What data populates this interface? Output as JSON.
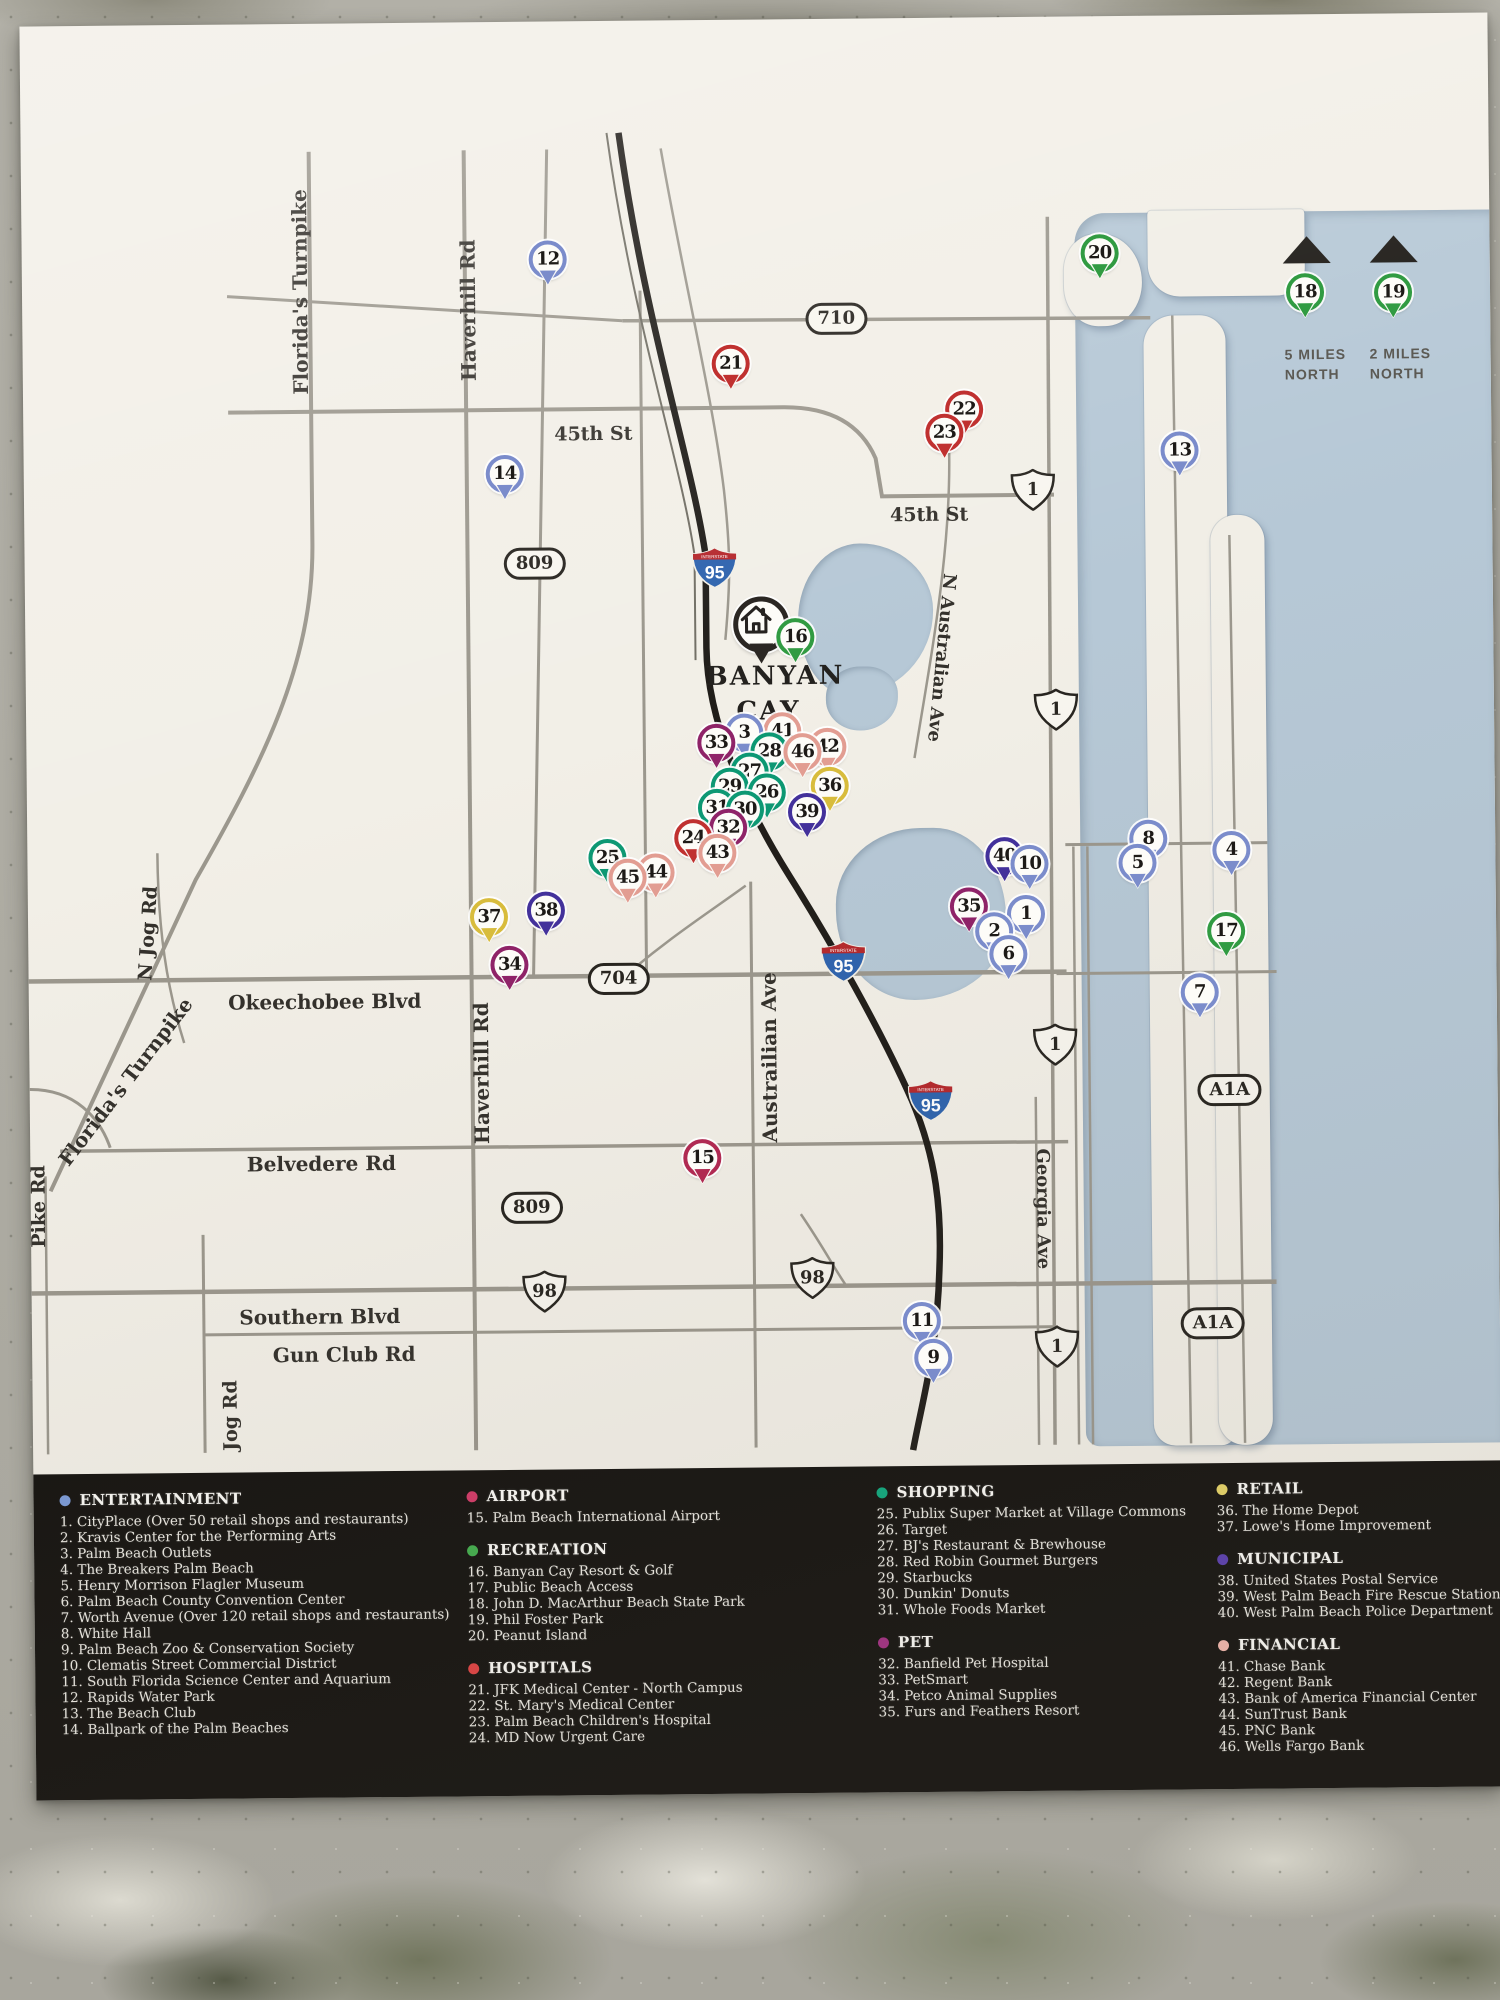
{
  "map": {
    "colors": {
      "land": "#f2efe7",
      "water": "#b6c8d6",
      "interstate_blue": "#2e63ae",
      "interstate_red": "#b5282c"
    },
    "home": {
      "label": "BANYAN CAY",
      "icon": "home-icon",
      "x": 736,
      "y": 605
    },
    "compass": [
      {
        "pin": 18,
        "lines": "5 MILES NORTH",
        "x": 1262,
        "tri_x": 1285
      },
      {
        "pin": 19,
        "lines": "2 MILES NORTH",
        "x": 1347,
        "tri_x": 1372
      }
    ],
    "categories": {
      "entertainment": {
        "label": "ENTERTAINMENT",
        "dot": "#7b9bd8",
        "pin": "#7b8ccb"
      },
      "airport": {
        "label": "AIRPORT",
        "dot": "#d23a68",
        "pin": "#b02a52"
      },
      "recreation": {
        "label": "RECREATION",
        "dot": "#43ae4e",
        "pin": "#319b42"
      },
      "hospitals": {
        "label": "HOSPITALS",
        "dot": "#e04343",
        "pin": "#c03130"
      },
      "shopping": {
        "label": "SHOPPING",
        "dot": "#10a87e",
        "pin": "#0d9873"
      },
      "pet": {
        "label": "PET",
        "dot": "#a23083",
        "pin": "#8f2368"
      },
      "retail": {
        "label": "RETAIL",
        "dot": "#e6d468",
        "pin": "#d8bc3c"
      },
      "municipal": {
        "label": "MUNICIPAL",
        "dot": "#5a3fb0",
        "pin": "#43319b"
      },
      "financial": {
        "label": "FINANCIAL",
        "dot": "#f2b7ad",
        "pin": "#e29d92"
      }
    },
    "pins": [
      {
        "n": 1,
        "cat": "entertainment",
        "x": 998,
        "y": 897
      },
      {
        "n": 2,
        "cat": "entertainment",
        "x": 966,
        "y": 914
      },
      {
        "n": 3,
        "cat": "entertainment",
        "x": 718,
        "y": 713
      },
      {
        "n": 4,
        "cat": "entertainment",
        "x": 1204,
        "y": 835
      },
      {
        "n": 5,
        "cat": "entertainment",
        "x": 1110,
        "y": 847
      },
      {
        "n": 6,
        "cat": "entertainment",
        "x": 980,
        "y": 937
      },
      {
        "n": 7,
        "cat": "entertainment",
        "x": 1171,
        "y": 977
      },
      {
        "n": 8,
        "cat": "entertainment",
        "x": 1121,
        "y": 823
      },
      {
        "n": 9,
        "cat": "entertainment",
        "x": 901,
        "y": 1340
      },
      {
        "n": 10,
        "cat": "entertainment",
        "x": 1002,
        "y": 847
      },
      {
        "n": 11,
        "cat": "entertainment",
        "x": 890,
        "y": 1303
      },
      {
        "n": 12,
        "cat": "entertainment",
        "x": 526,
        "y": 238
      },
      {
        "n": 13,
        "cat": "entertainment",
        "x": 1156,
        "y": 435
      },
      {
        "n": 14,
        "cat": "entertainment",
        "x": 481,
        "y": 452
      },
      {
        "n": 15,
        "cat": "airport",
        "x": 672,
        "y": 1138
      },
      {
        "n": 16,
        "cat": "recreation",
        "x": 770,
        "y": 618
      },
      {
        "n": 17,
        "cat": "recreation",
        "x": 1198,
        "y": 916
      },
      {
        "n": 18,
        "cat": "recreation",
        "x": 1283,
        "y": 278
      },
      {
        "n": 19,
        "cat": "recreation",
        "x": 1371,
        "y": 279
      },
      {
        "n": 20,
        "cat": "recreation",
        "x": 1078,
        "y": 237
      },
      {
        "n": 21,
        "cat": "hospitals",
        "x": 708,
        "y": 344
      },
      {
        "n": 22,
        "cat": "hospitals",
        "x": 941,
        "y": 392
      },
      {
        "n": 23,
        "cat": "hospitals",
        "x": 921,
        "y": 415
      },
      {
        "n": 24,
        "cat": "hospitals",
        "x": 666,
        "y": 818
      },
      {
        "n": 25,
        "cat": "shopping",
        "x": 580,
        "y": 837
      },
      {
        "n": 26,
        "cat": "shopping",
        "x": 740,
        "y": 773
      },
      {
        "n": 27,
        "cat": "shopping",
        "x": 723,
        "y": 752
      },
      {
        "n": 28,
        "cat": "shopping",
        "x": 743,
        "y": 732
      },
      {
        "n": 29,
        "cat": "shopping",
        "x": 703,
        "y": 767
      },
      {
        "n": 30,
        "cat": "shopping",
        "x": 718,
        "y": 790
      },
      {
        "n": 31,
        "cat": "shopping",
        "x": 690,
        "y": 788
      },
      {
        "n": 32,
        "cat": "pet",
        "x": 701,
        "y": 808
      },
      {
        "n": 33,
        "cat": "pet",
        "x": 690,
        "y": 723
      },
      {
        "n": 34,
        "cat": "pet",
        "x": 481,
        "y": 943
      },
      {
        "n": 35,
        "cat": "pet",
        "x": 941,
        "y": 889
      },
      {
        "n": 36,
        "cat": "retail",
        "x": 803,
        "y": 767
      },
      {
        "n": 37,
        "cat": "retail",
        "x": 461,
        "y": 895
      },
      {
        "n": 38,
        "cat": "municipal",
        "x": 518,
        "y": 889
      },
      {
        "n": 39,
        "cat": "municipal",
        "x": 780,
        "y": 793
      },
      {
        "n": 40,
        "cat": "municipal",
        "x": 977,
        "y": 839
      },
      {
        "n": 41,
        "cat": "financial",
        "x": 756,
        "y": 712
      },
      {
        "n": 42,
        "cat": "financial",
        "x": 801,
        "y": 728
      },
      {
        "n": 43,
        "cat": "financial",
        "x": 690,
        "y": 833
      },
      {
        "n": 44,
        "cat": "financial",
        "x": 628,
        "y": 852
      },
      {
        "n": 45,
        "cat": "financial",
        "x": 600,
        "y": 857
      },
      {
        "n": 46,
        "cat": "financial",
        "x": 776,
        "y": 733
      }
    ],
    "shields": [
      {
        "type": "oval",
        "label": "710",
        "x": 814,
        "y": 300
      },
      {
        "type": "oval",
        "label": "809",
        "x": 510,
        "y": 542
      },
      {
        "type": "oval",
        "label": "809",
        "x": 501,
        "y": 1186
      },
      {
        "type": "oval",
        "label": "704",
        "x": 590,
        "y": 958
      },
      {
        "type": "oval",
        "label": "A1A",
        "x": 1200,
        "y": 1075
      },
      {
        "type": "oval",
        "label": "A1A",
        "x": 1181,
        "y": 1308
      },
      {
        "type": "us",
        "label": "1",
        "x": 1009,
        "y": 473
      },
      {
        "type": "us",
        "label": "1",
        "x": 1030,
        "y": 693
      },
      {
        "type": "us",
        "label": "1",
        "x": 1026,
        "y": 1028
      },
      {
        "type": "us",
        "label": "1",
        "x": 1025,
        "y": 1330
      },
      {
        "type": "us",
        "label": "98",
        "x": 513,
        "y": 1270
      },
      {
        "type": "us",
        "label": "98",
        "x": 781,
        "y": 1259
      },
      {
        "type": "interstate",
        "label": "95",
        "band": "INTERSTATE",
        "x": 690,
        "y": 548
      },
      {
        "type": "interstate",
        "label": "95",
        "band": "INTERSTATE",
        "x": 815,
        "y": 943
      },
      {
        "type": "interstate",
        "label": "95",
        "band": "INTERSTATE",
        "x": 901,
        "y": 1083
      }
    ],
    "road_labels": [
      {
        "text": "Florida's Turnpike",
        "x": 278,
        "y": 268,
        "rot": -90,
        "size": 20
      },
      {
        "text": "Haverhill Rd",
        "x": 446,
        "y": 288,
        "rot": -90,
        "size": 20
      },
      {
        "text": "45th St",
        "x": 570,
        "y": 413,
        "rot": 0,
        "size": 19
      },
      {
        "text": "45th St",
        "x": 905,
        "y": 497,
        "rot": 0,
        "size": 19
      },
      {
        "text": "N Australian Ave",
        "x": 916,
        "y": 640,
        "rot": 96,
        "size": 18
      },
      {
        "text": "N Jog Rd",
        "x": 120,
        "y": 908,
        "rot": -86,
        "size": 19
      },
      {
        "text": "Okeechobee Blvd",
        "x": 296,
        "y": 978,
        "rot": 0,
        "size": 20
      },
      {
        "text": "Haverhill Rd",
        "x": 452,
        "y": 1051,
        "rot": -90,
        "size": 20
      },
      {
        "text": "Austrailian Ave",
        "x": 740,
        "y": 1038,
        "rot": -90,
        "size": 20
      },
      {
        "text": "Florida's Turnpike",
        "x": 96,
        "y": 1056,
        "rot": -52,
        "size": 20
      },
      {
        "text": "Belvedere Rd",
        "x": 291,
        "y": 1140,
        "rot": 0,
        "size": 20
      },
      {
        "text": "Pike Rd",
        "x": 8,
        "y": 1180,
        "rot": -90,
        "size": 19
      },
      {
        "text": "Georgia Ave",
        "x": 1012,
        "y": 1192,
        "rot": 90,
        "size": 18
      },
      {
        "text": "Southern Blvd",
        "x": 288,
        "y": 1293,
        "rot": 0,
        "size": 20
      },
      {
        "text": "Gun Club Rd",
        "x": 312,
        "y": 1331,
        "rot": 0,
        "size": 20
      },
      {
        "text": "Jog Rd",
        "x": 198,
        "y": 1391,
        "rot": -90,
        "size": 19
      }
    ]
  },
  "legend": {
    "columns": [
      {
        "x": 26,
        "categories": [
          {
            "key": "entertainment",
            "items": [
              {
                "n": 1,
                "label": "CityPlace (Over 50 retail shops and restaurants)"
              },
              {
                "n": 2,
                "label": "Kravis Center for the Performing Arts"
              },
              {
                "n": 3,
                "label": "Palm Beach Outlets"
              },
              {
                "n": 4,
                "label": "The Breakers Palm Beach"
              },
              {
                "n": 5,
                "label": "Henry Morrison Flagler Museum"
              },
              {
                "n": 6,
                "label": "Palm Beach County Convention Center"
              },
              {
                "n": 7,
                "label": "Worth Avenue (Over 120 retail shops and restaurants)"
              },
              {
                "n": 8,
                "label": "White Hall"
              },
              {
                "n": 9,
                "label": "Palm Beach Zoo & Conservation Society"
              },
              {
                "n": 10,
                "label": "Clematis Street Commercial District"
              },
              {
                "n": 11,
                "label": "South Florida Science Center and Aquarium"
              },
              {
                "n": 12,
                "label": "Rapids Water Park"
              },
              {
                "n": 13,
                "label": "The Beach Club"
              },
              {
                "n": 14,
                "label": "Ballpark of the Palm Beaches"
              }
            ]
          }
        ]
      },
      {
        "x": 433,
        "categories": [
          {
            "key": "airport",
            "items": [
              {
                "n": 15,
                "label": "Palm Beach International Airport"
              }
            ]
          },
          {
            "key": "recreation",
            "items": [
              {
                "n": 16,
                "label": "Banyan Cay Resort & Golf"
              },
              {
                "n": 17,
                "label": "Public Beach Access"
              },
              {
                "n": 18,
                "label": "John D. MacArthur Beach State Park"
              },
              {
                "n": 19,
                "label": "Phil Foster Park"
              },
              {
                "n": 20,
                "label": "Peanut Island"
              }
            ]
          },
          {
            "key": "hospitals",
            "items": [
              {
                "n": 21,
                "label": "JFK Medical Center - North Campus"
              },
              {
                "n": 22,
                "label": "St. Mary's Medical Center"
              },
              {
                "n": 23,
                "label": "Palm Beach Children's Hospital"
              },
              {
                "n": 24,
                "label": "MD Now Urgent Care"
              }
            ]
          }
        ]
      },
      {
        "x": 843,
        "categories": [
          {
            "key": "shopping",
            "items": [
              {
                "n": 25,
                "label": "Publix Super Market at Village Commons"
              },
              {
                "n": 26,
                "label": "Target"
              },
              {
                "n": 27,
                "label": "BJ's Restaurant & Brewhouse"
              },
              {
                "n": 28,
                "label": "Red Robin Gourmet Burgers"
              },
              {
                "n": 29,
                "label": "Starbucks"
              },
              {
                "n": 30,
                "label": "Dunkin' Donuts"
              },
              {
                "n": 31,
                "label": "Whole Foods Market"
              }
            ]
          },
          {
            "key": "pet",
            "items": [
              {
                "n": 32,
                "label": "Banfield Pet Hospital"
              },
              {
                "n": 33,
                "label": "PetSmart"
              },
              {
                "n": 34,
                "label": "Petco Animal Supplies"
              },
              {
                "n": 35,
                "label": "Furs and Feathers Resort"
              }
            ]
          }
        ]
      },
      {
        "x": 1183,
        "categories": [
          {
            "key": "retail",
            "items": [
              {
                "n": 36,
                "label": "The Home Depot"
              },
              {
                "n": 37,
                "label": "Lowe's Home Improvement"
              }
            ]
          },
          {
            "key": "municipal",
            "items": [
              {
                "n": 38,
                "label": "United States Postal Service"
              },
              {
                "n": 39,
                "label": "West Palm Beach Fire Rescue Station 5"
              },
              {
                "n": 40,
                "label": "West Palm Beach Police Department"
              }
            ]
          },
          {
            "key": "financial",
            "items": [
              {
                "n": 41,
                "label": "Chase Bank"
              },
              {
                "n": 42,
                "label": "Regent Bank"
              },
              {
                "n": 43,
                "label": "Bank of America Financial Center"
              },
              {
                "n": 44,
                "label": "SunTrust Bank"
              },
              {
                "n": 45,
                "label": "PNC Bank"
              },
              {
                "n": 46,
                "label": "Wells Fargo Bank"
              }
            ]
          }
        ]
      }
    ]
  }
}
